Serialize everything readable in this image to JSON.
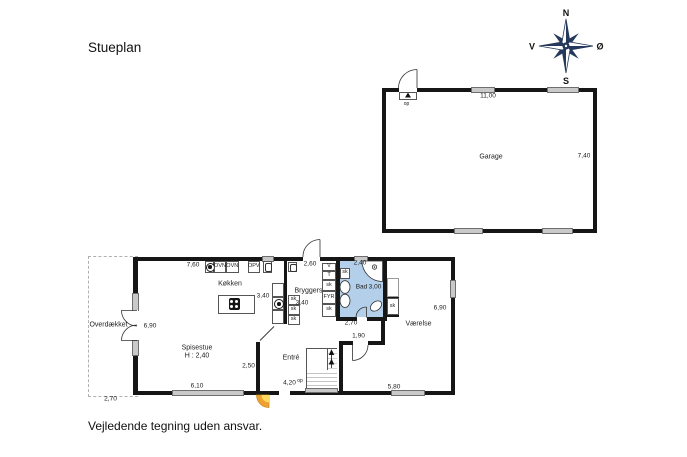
{
  "title": "Stueplan",
  "footer": "Vejledende tegning uden ansvar.",
  "compass": {
    "north": "N",
    "south": "S",
    "west": "V",
    "east": "Ø"
  },
  "garage": {
    "label": "Garage",
    "width_dim": "11,00",
    "depth_dim": "7,40",
    "door": "op"
  },
  "kitchen": {
    "label": "Køkken",
    "top_dim": "7,60",
    "side_dim": "3,40",
    "oven1": "OVN",
    "oven2": "OVN",
    "dishwasher": "OPV"
  },
  "bryggers": {
    "label": "Bryggers",
    "top_dim": "2,60",
    "side_dim": "3,40",
    "sk1": "sk",
    "sk2": "sk",
    "sk3": "sk"
  },
  "tech": {
    "v": "V",
    "t": "T",
    "sk_top": "sk",
    "fyr": "FYR",
    "sk_bottom": "sk"
  },
  "bad": {
    "label": "Bad",
    "dim": "3,00",
    "top_dim": "2,40",
    "bottom_dim": "2,70",
    "sk": "sk"
  },
  "closet": {
    "sk": "sk"
  },
  "vaerelse": {
    "label": "Værelse",
    "side_dim": "6,90",
    "corridor_dim": "1,90",
    "bottom_dim": "5,80"
  },
  "entre": {
    "label": "Entré",
    "bottom_dim": "4,20",
    "stairs_op": "op"
  },
  "spisestue": {
    "label": "Spisestue",
    "height_note": "H : 2,40",
    "bottom_dim": "6,10",
    "side_dim": "6,90",
    "inner_dim": "2,50"
  },
  "terrace": {
    "label": "Overdækket",
    "bottom_dim": "2,70"
  },
  "colors": {
    "wall": "#161616",
    "window": "#c9c9c9",
    "bath_fill": "#b3cfea",
    "entrance_outer": "#f0a030",
    "entrance_inner": "#ffd95e",
    "compass": "#25395c"
  }
}
